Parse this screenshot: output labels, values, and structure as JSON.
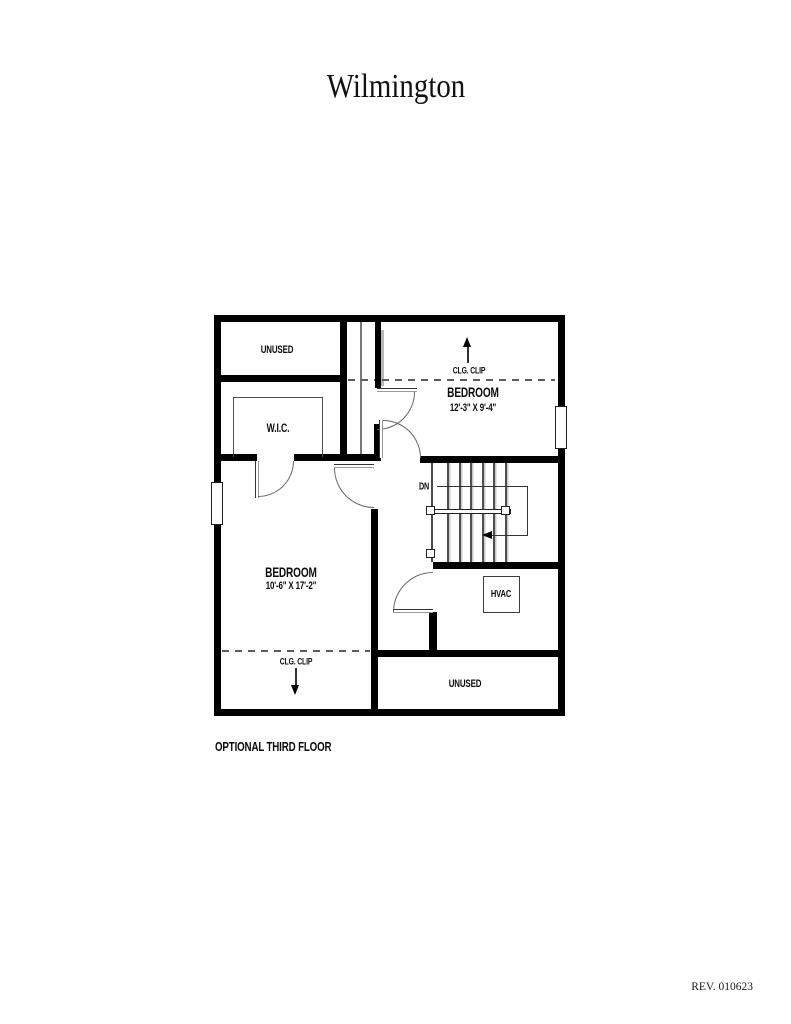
{
  "page": {
    "title": "Wilmington",
    "caption": "OPTIONAL THIRD FLOOR",
    "revision": "REV. 010623"
  },
  "plan": {
    "rooms": {
      "unused_top": {
        "label": "UNUSED"
      },
      "wic": {
        "label": "W.I.C."
      },
      "bedroom_right": {
        "label": "BEDROOM",
        "dims": "12'-3\" X 9'-4\""
      },
      "bedroom_left": {
        "label": "BEDROOM",
        "dims": "10'-6\" X 17'-2\""
      },
      "hvac": {
        "label": "HVAC"
      },
      "unused_bottom": {
        "label": "UNUSED"
      }
    },
    "annotations": {
      "clg_clip_top": "CLG. CLIP",
      "clg_clip_bottom": "CLG. CLIP",
      "stairs_down": "DN"
    },
    "colors": {
      "wall": "#000000",
      "line": "#555555",
      "shadow": "#b9b9b9"
    }
  }
}
